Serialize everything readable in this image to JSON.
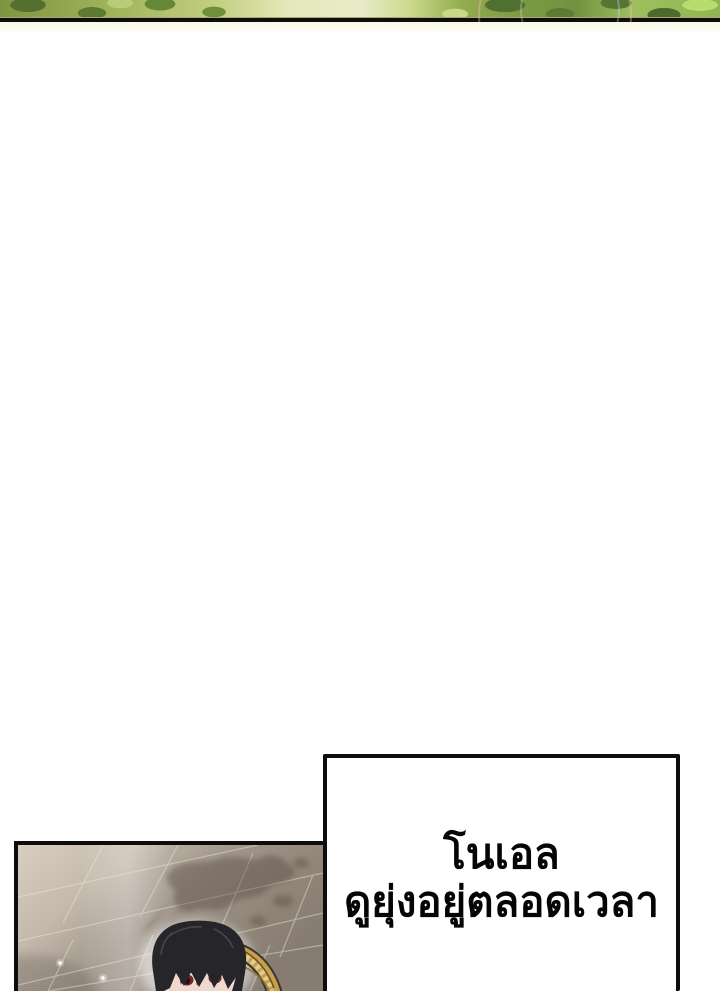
{
  "page": {
    "width_px": 720,
    "height_px": 991,
    "background_color": "#ffffff",
    "description": "webtoon/comic page segment: foliage strip cropped at top, large white gutter, speech bubble and panel cropped at bottom"
  },
  "foliage_banner": {
    "description": "green leafy artwork strip with faint soap-bubble arcs, cut by page edge",
    "green_colors": [
      "#7f9440",
      "#a3b75e",
      "#e9ecc8",
      "#7d9a42",
      "#b4d86e",
      "#4d6b2c"
    ],
    "bubble_arc_colors": [
      "#ffb9d2",
      "#b9e6ff"
    ],
    "bottom_rule_color": "#0f0d07"
  },
  "speech_bubble": {
    "lines": [
      "โนเอล",
      "ดูยุ่งอยู่ตลอดเวลา"
    ],
    "text_color": "#050505",
    "background_color": "#ffffff",
    "border_color": "#0d0d0d"
  },
  "comic_panel": {
    "description": "angled stone-tile floor with cast plant shadow and sparkles; black-haired character with dark red eyes beside an ornate gold frame, cropped by page bottom",
    "border_color": "#0c0c0c",
    "floor_light_color": "#d8cec1",
    "floor_dark_color": "#877c72",
    "grout_line_color": "#efe7db",
    "shadow_color": "#55483f",
    "sparkle_color": "#ffffff",
    "character": {
      "hair_color": "#26252a",
      "skin_color": "#f3e0d7",
      "eye_color": "#6f2433",
      "gold_trim_color": "#c6a04f"
    }
  }
}
